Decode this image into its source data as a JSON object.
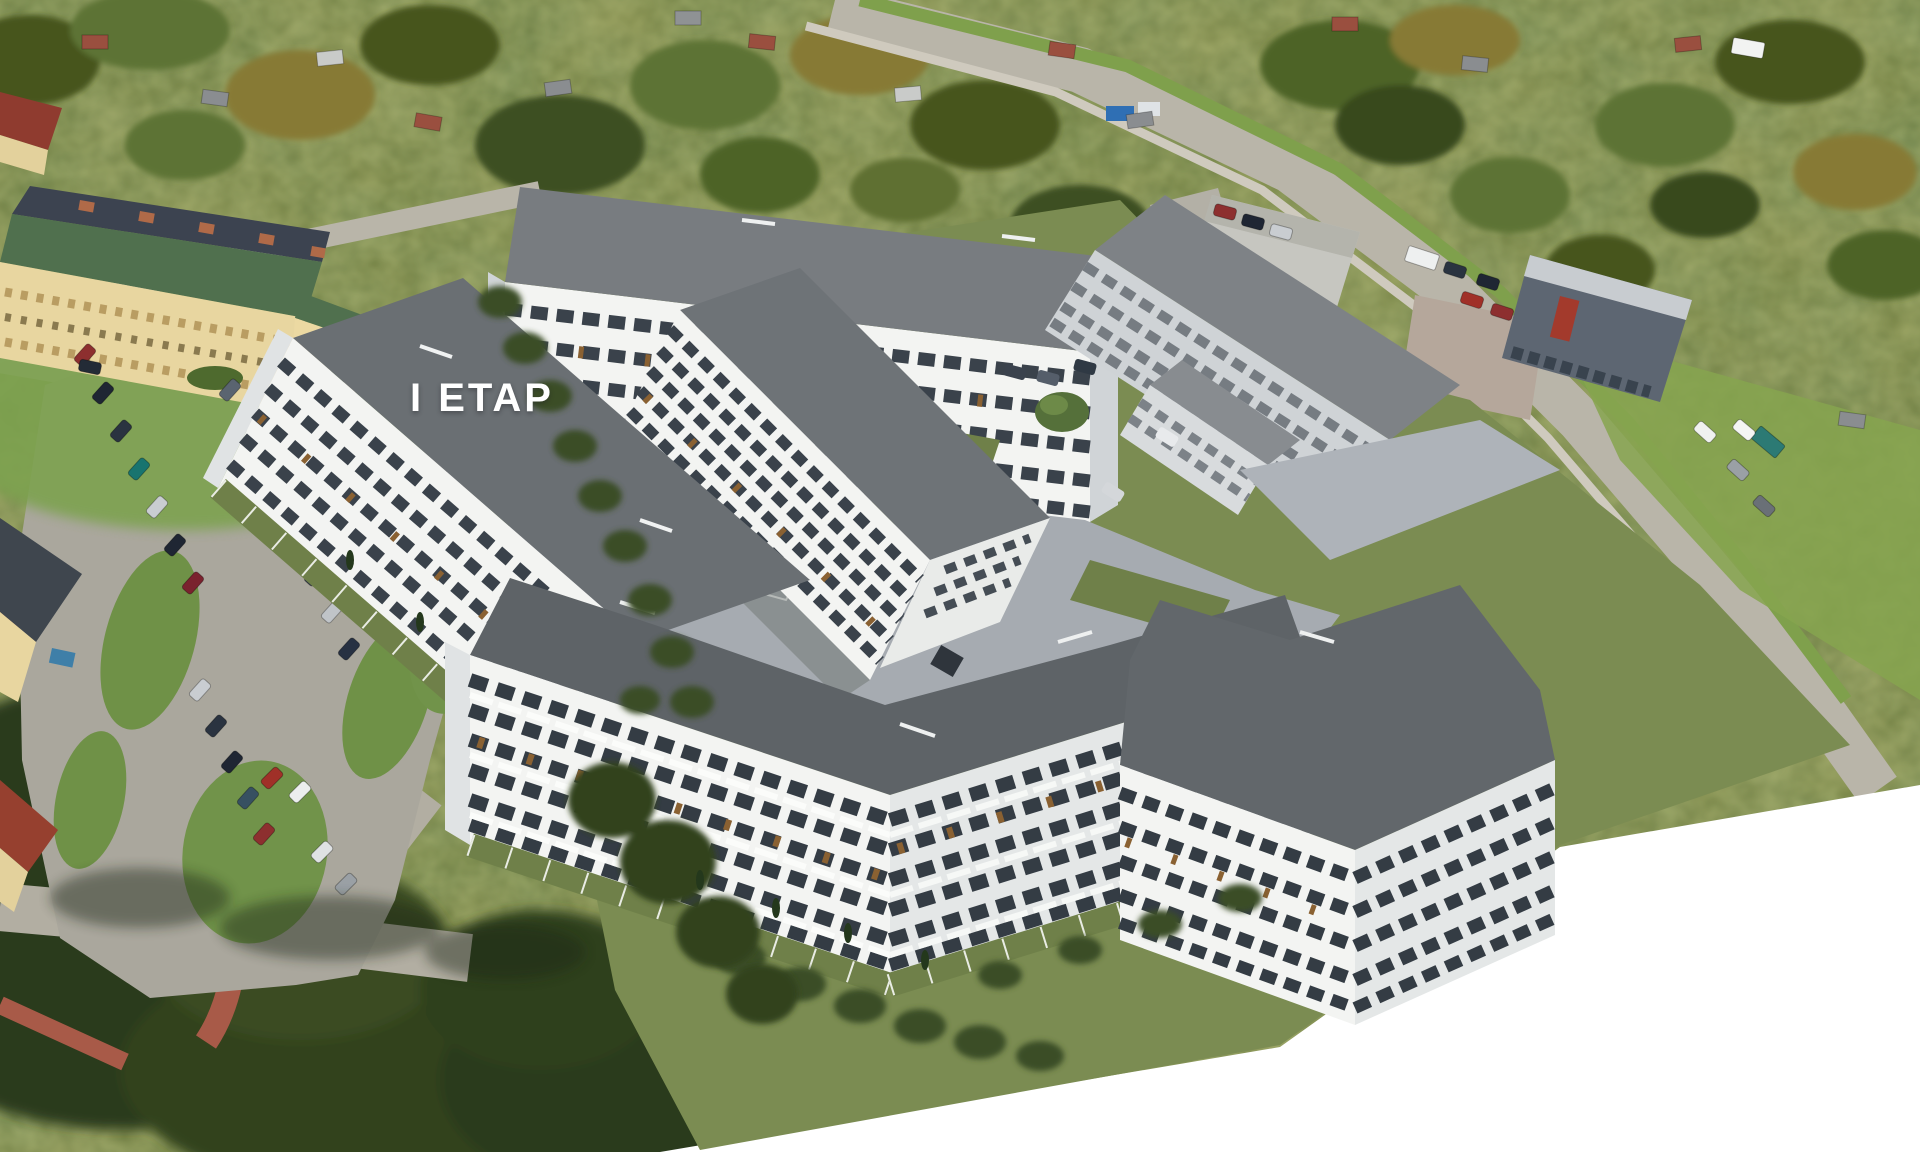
{
  "scene": {
    "phase_label": "I ETAP",
    "media": "aerial photograph with 3D architectural visualization overlay",
    "subject": "residential estate of white multi-family buildings around a paved courtyard",
    "rendered_buildings_visible": 8,
    "typical_floors_visible": 5,
    "surroundings": "allotment gardens and trees, existing yellow apartment block, car parking lots, commercial buildings, diagonal main road",
    "backdrop_corner": "white untextured render background in bottom-right corner"
  },
  "palette": {
    "backdrop_white": "#ffffff",
    "photo_tree_dark": "#33431f",
    "photo_tree_mid": "#5d7334",
    "photo_tree_light": "#87a04b",
    "photo_autumn_olive": "#9f9040",
    "photo_grass": "#7da24f",
    "photo_road": "#b9b5a9",
    "photo_red_path": "#a85a48",
    "existing_wall_cream": "#e8d6a0",
    "existing_roof_green": "#50704e",
    "existing_roof_dark": "#3c4350",
    "chimney_orange": "#b06a48",
    "render_lawn": "#7b8c52",
    "render_pavement": "#a6abb1",
    "render_roof_gray": "#6a6f73",
    "render_wall_white": "#f3f4f2",
    "render_wall_shaded": "#d0d4d7",
    "render_window_dark": "#384048",
    "render_wood_accent": "#8a6132",
    "label_color": "#ffffff"
  }
}
